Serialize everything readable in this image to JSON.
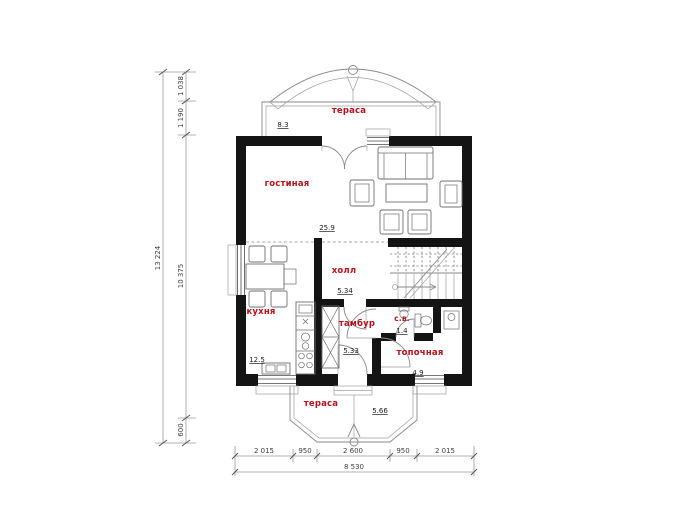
{
  "rooms": {
    "terrace_top": {
      "label": "тераса",
      "area": "8.3"
    },
    "living": {
      "label": "гостиная",
      "area": "25.9"
    },
    "hall": {
      "label": "холл",
      "area": "5.34"
    },
    "kitchen": {
      "label": "кухня",
      "area": "12.5"
    },
    "tambour": {
      "label": "тамбур",
      "area": "5.33"
    },
    "wc": {
      "label": "с.в.",
      "area": "1.4"
    },
    "boiler": {
      "label": "топочная",
      "area": "4.9"
    },
    "terrace_bottom": {
      "label": "тераса",
      "area": "5.66"
    }
  },
  "dimensions": {
    "left_total": "13 224",
    "left_parts": [
      "1 038",
      "1 190",
      "10 375",
      "600"
    ],
    "bottom_parts": [
      "2 015",
      "950",
      "2 600",
      "950",
      "2 015"
    ],
    "bottom_total": "8 530"
  },
  "colors": {
    "wall": "#141414",
    "room_label": "#b5121b",
    "dimension_text": "#3d3d3d",
    "drawing_line": "#8a8a8a"
  }
}
